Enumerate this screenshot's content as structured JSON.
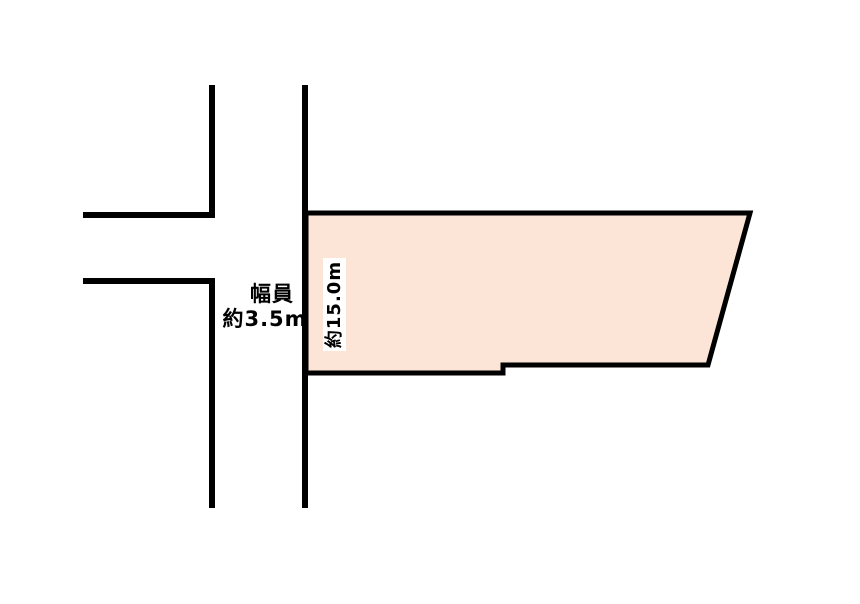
{
  "diagram": {
    "kind": "land-plot-site-plan",
    "colors": {
      "background": "#ffffff",
      "road_line": "#000000",
      "parcel_fill": "#fce4d6",
      "parcel_outline": "#000000",
      "label_background": "#ffffff",
      "label_text": "#000000"
    },
    "labels": {
      "road_width_line1": "幅員",
      "road_width_line2": "約3.5m",
      "parcel_frontage": "約15.0m"
    }
  }
}
